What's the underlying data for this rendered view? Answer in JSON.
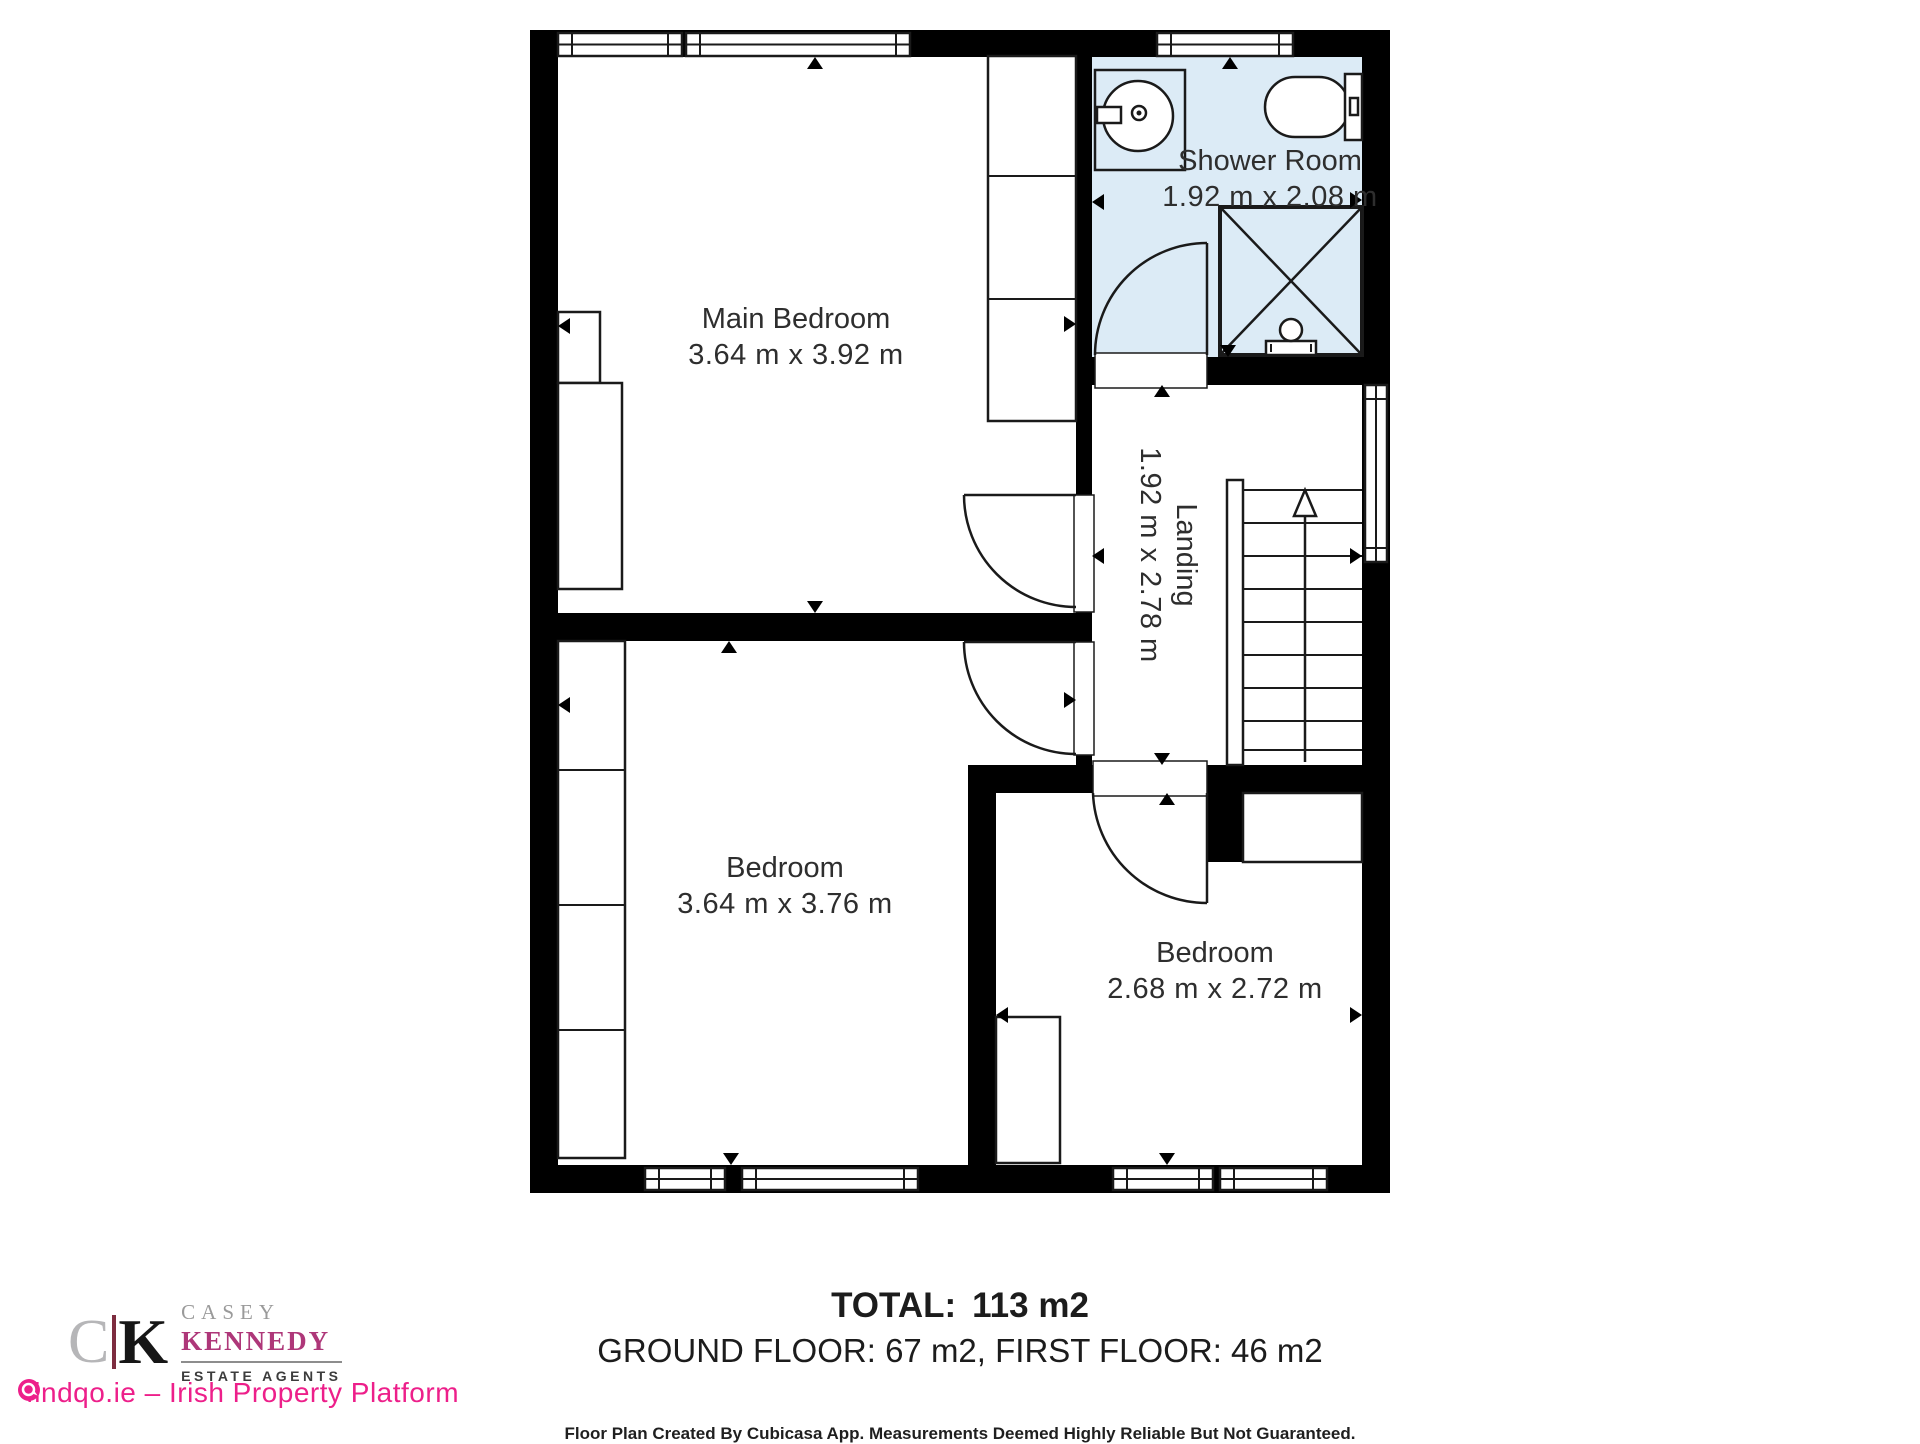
{
  "plan": {
    "rooms": [
      {
        "id": "main-bedroom",
        "name": "Main Bedroom",
        "dims": "3.64 m x 3.92 m"
      },
      {
        "id": "shower-room",
        "name": "Shower Room",
        "dims": "1.92 m x 2.08 m"
      },
      {
        "id": "landing",
        "name": "Landing",
        "dims": "1.92 m x 2.78 m"
      },
      {
        "id": "bedroom-left",
        "name": "Bedroom",
        "dims": "3.64 m x 3.76 m"
      },
      {
        "id": "bedroom-right",
        "name": "Bedroom",
        "dims": "2.68 m x 2.72 m"
      }
    ],
    "fixtures": [
      "sink",
      "toilet",
      "shower-enclosure",
      "staircase",
      "wardrobes",
      "doors",
      "windows"
    ]
  },
  "summary": {
    "total_label": "TOTAL:",
    "total_value": "113 m2",
    "floors": "GROUND FLOOR: 67 m2, FIRST FLOOR: 46 m2"
  },
  "disclaimer": "Floor Plan Created By Cubicasa App. Measurements Deemed Highly Reliable But Not Guaranteed.",
  "branding": {
    "agency": {
      "monogram_c": "C",
      "monogram_k": "K",
      "name_line1": "CASEY",
      "name_line2": "KENNEDY",
      "tagline": "ESTATE AGENTS"
    },
    "platform": {
      "label": "findqo.ie – Irish Property Platform"
    }
  },
  "colors": {
    "wall": "#000000",
    "shower_fill": "#dcebf6",
    "line": "#1a1a1a",
    "label_text": "#2e2e2e",
    "brand_pink": "#ed1f8a",
    "brand_berry": "#ae3779",
    "brand_maroon": "#7d2c3f",
    "brand_gray": "#9a9a9a"
  }
}
